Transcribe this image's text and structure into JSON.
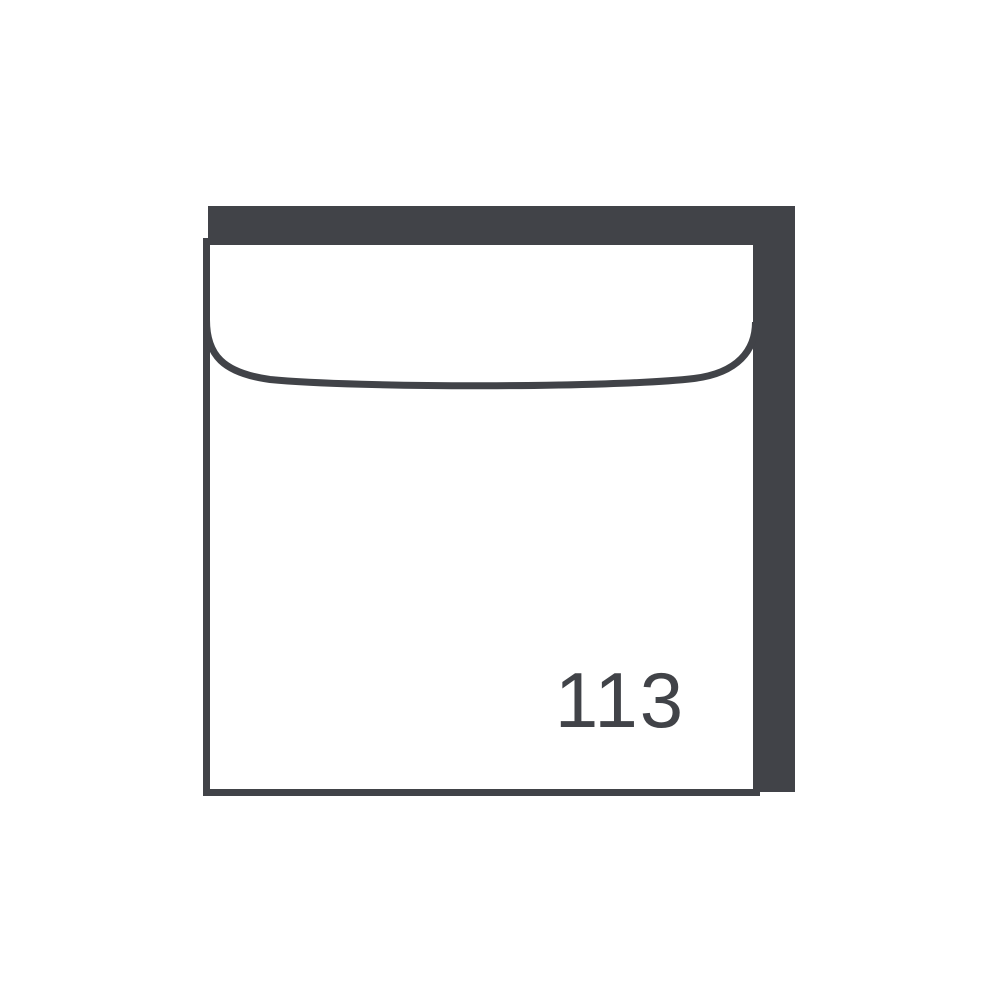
{
  "graphic": {
    "icon": "square-envelope-icon",
    "label": "113",
    "colors": {
      "ink": "#414348",
      "paper": "#FFFFFF"
    }
  }
}
